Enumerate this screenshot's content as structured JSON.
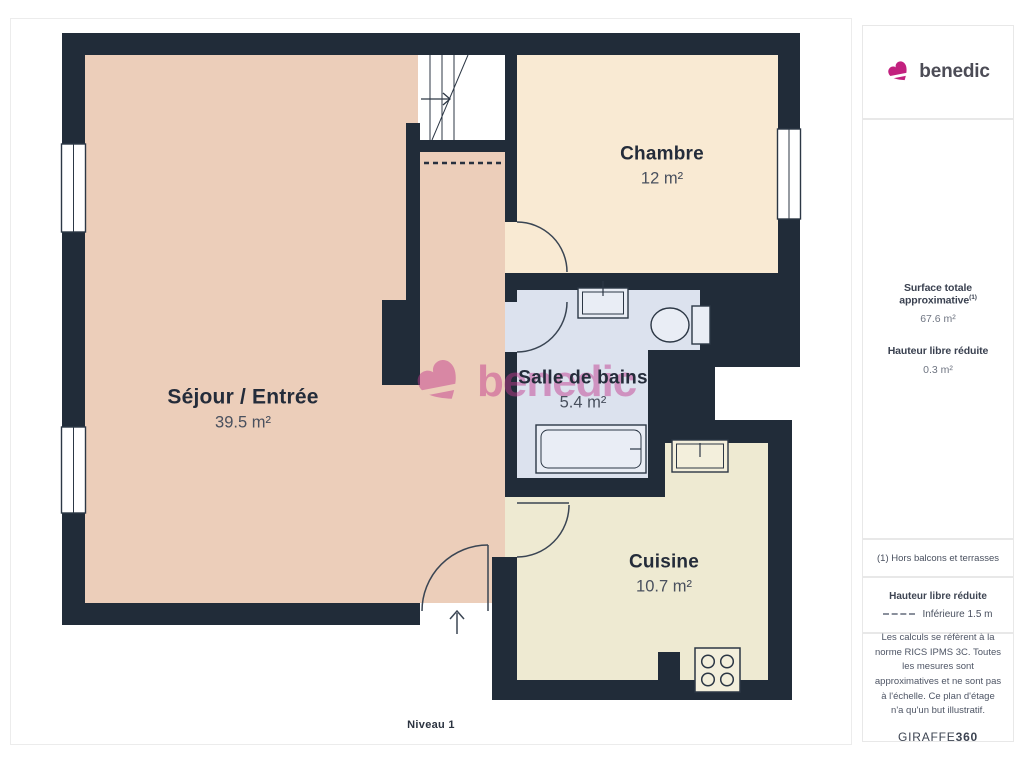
{
  "brand": {
    "name": "benedic",
    "color": "#c2217f"
  },
  "sidebar": {
    "surface": {
      "label": "Surface totale approximative",
      "marker": "(1)",
      "value": "67.6 m²",
      "height_label": "Hauteur libre réduite",
      "height_value": "0.3 m²"
    },
    "footnote": "(1) Hors balcons et terrasses",
    "legend": {
      "title": "Hauteur libre réduite",
      "item": "Inférieure 1.5 m"
    },
    "disclaimer": "Les calculs se réfèrent à la norme RICS IPMS 3C. Toutes les mesures sont approximatives et ne sont pas à l'échelle. Ce plan d'étage n'a qu'un but illustratif.",
    "provider": {
      "name": "GIRAFFE",
      "suffix": "360"
    }
  },
  "plan": {
    "level_label": "Niveau 1",
    "watermark": "benedic",
    "rooms": [
      {
        "name": "Séjour / Entrée",
        "area": "39.5 m²",
        "color": "#ecceba"
      },
      {
        "name": "Chambre",
        "area": "12 m²",
        "color": "#f9ead3"
      },
      {
        "name": "Salle de bains",
        "area": "5.4 m²",
        "color": "#dce2ee"
      },
      {
        "name": "Cuisine",
        "area": "10.7 m²",
        "color": "#eeead2"
      }
    ],
    "colors": {
      "wall": "#212c39",
      "watermark_pink": "#c2398d"
    }
  }
}
